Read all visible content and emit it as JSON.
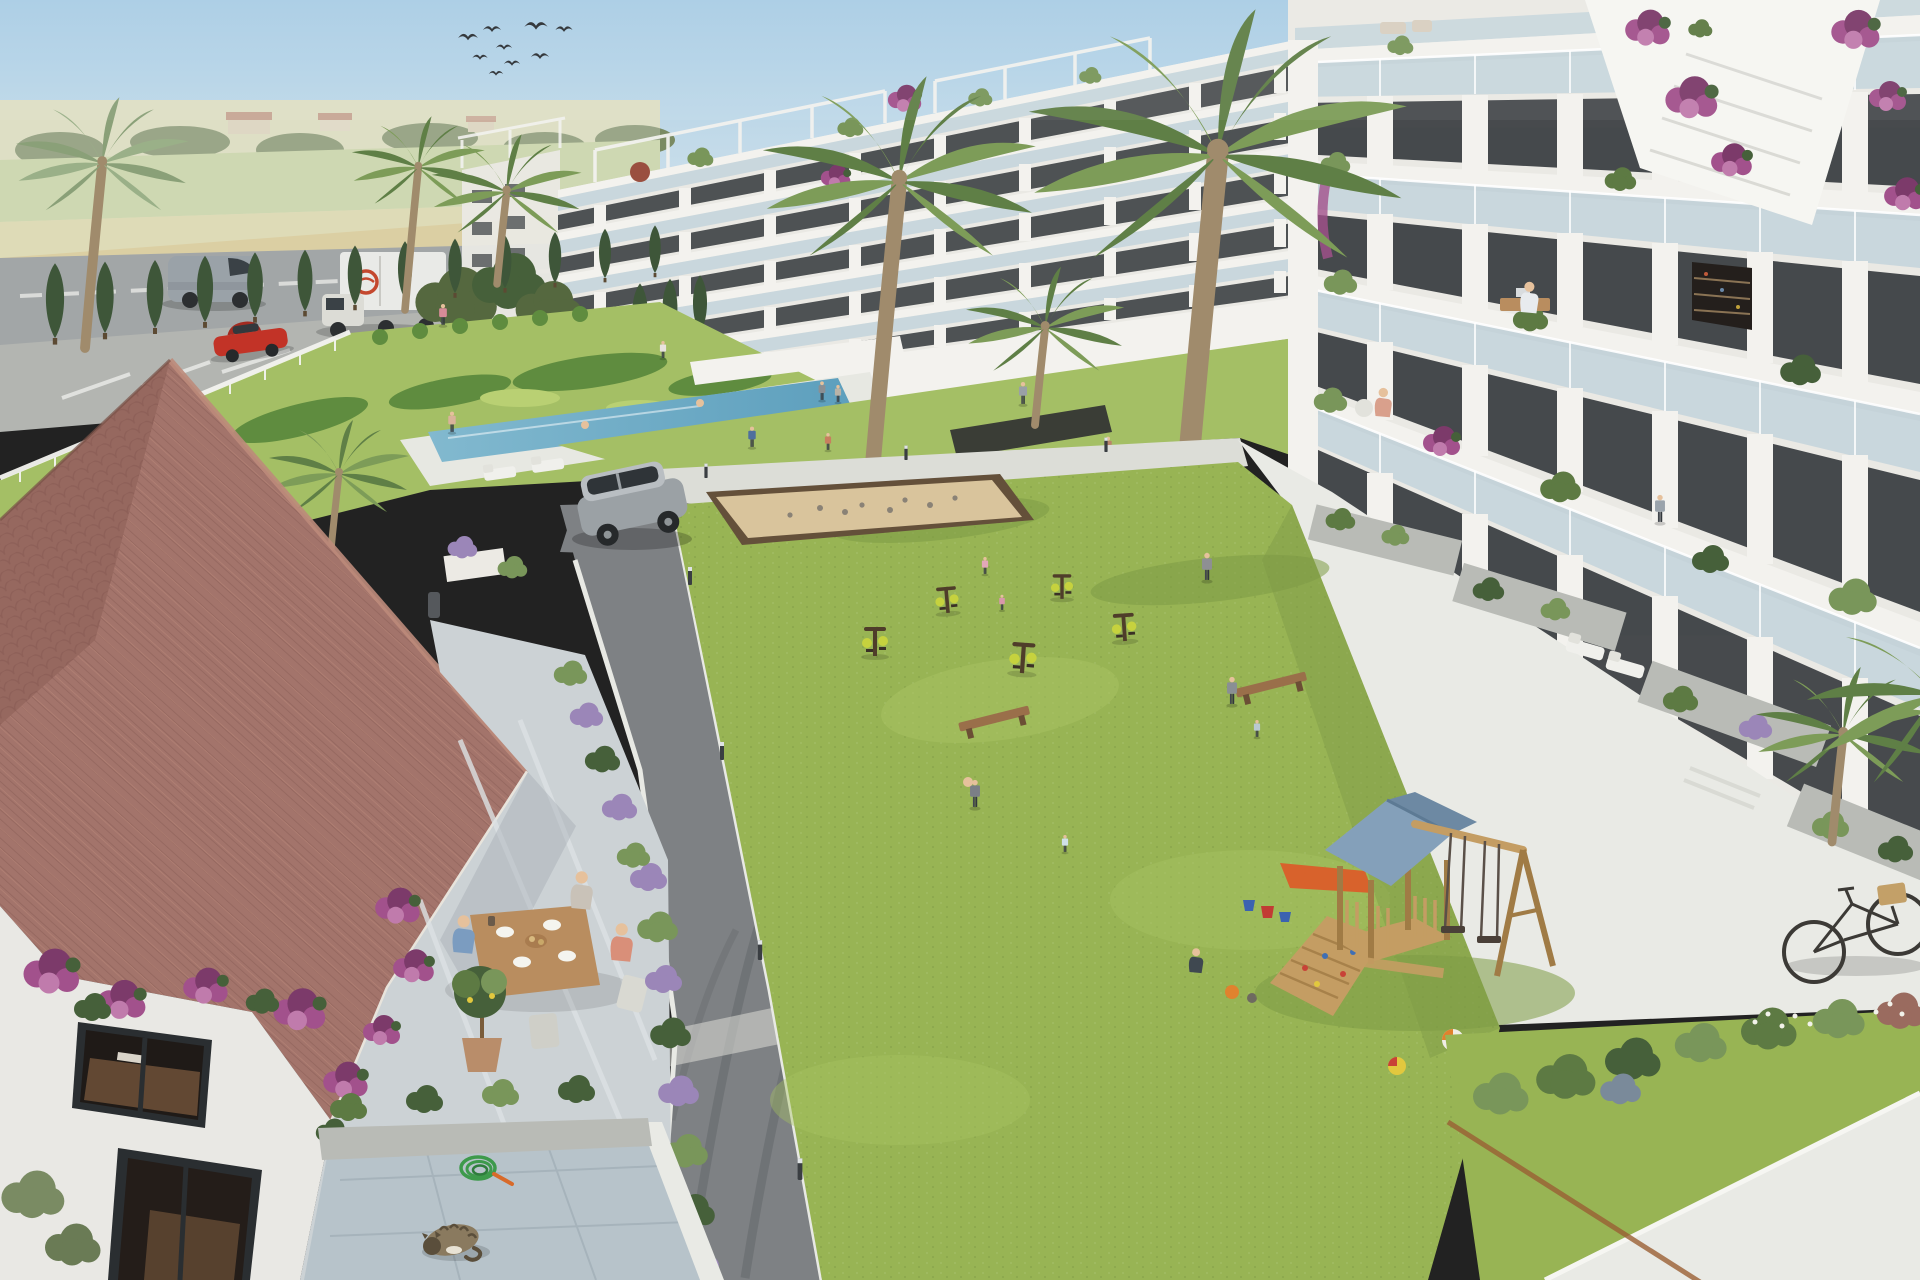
{
  "scene": {
    "title": "Residential complex aerial render",
    "description": "Sunny 3D architectural rendering of a Mediterranean apartment complex: two modern white apartment blocks with glass balconies around a communal lawn with playground, outdoor gym and petanque court, a swimming pool garden, a traditional terracotta-roof house with dining terrace in the foreground, farmland and a road with vehicles in the background, a flock of birds in the sky, a sleeping cat and a bicycle.",
    "objects": {
      "birds": {
        "count": 9
      },
      "vehicles": [
        "delivery-van",
        "box-truck",
        "red-car",
        "silver-suv"
      ],
      "buildings": [
        "far-left-block",
        "background-apartment-block",
        "right-apartment-block",
        "terracotta-roof-house"
      ],
      "amenities": [
        "swimming-pool",
        "decorative-hedge-garden",
        "petanque-court",
        "outdoor-gym",
        "children-playground",
        "communal-lawn",
        "asphalt-path"
      ],
      "playground_parts": [
        "wooden-play-tower",
        "blue-gable-roof",
        "climbing-ramp",
        "double-swing-set",
        "orange-slide",
        "beach-balls",
        "toy-buckets"
      ],
      "terrace_scene": [
        "dining-table",
        "three-diners",
        "potted-citrus-tree",
        "bougainvillea",
        "lavender-pots"
      ],
      "animals": [
        "sleeping-cat"
      ],
      "misc": [
        "garden-hose",
        "bicycle-with-basket",
        "benches",
        "bollard-lights",
        "cypress-row",
        "palm-trees",
        "sunbathers"
      ]
    },
    "people_estimate": 22
  },
  "palette": {
    "sky-top": "#a9cde5",
    "sky-low": "#e3ebee",
    "haze": "#eef0ee",
    "field-far": "#d8d8b6",
    "field-green": "#c3cf9b",
    "field-gold": "#d9d3a2",
    "wheat": "#d5c287",
    "wheat-hi": "#e0d2a0",
    "tree-far": "#7a8a62",
    "tree-dark": "#55683f",
    "road": "#a2a6a7",
    "parking": "#b3b5b1",
    "stripe": "#e8e9e6",
    "cypress": "#3e5639",
    "trunk": "#a08b6c",
    "frond1": "#5f7f46",
    "frond2": "#7d9c58",
    "frond-hazy": "#8aa078",
    "bldg-white": "#f3f2ee",
    "bldg-wall": "#eae9e4",
    "bldg-shadow": "#d7d7d2",
    "slab-shadow": "#b7b8b2",
    "glass": "#c5d5dc",
    "glass-hi": "#dfe9ec",
    "win-dark": "#383c40",
    "win-frame": "#2a2e31",
    "win-warm": "#6e5138",
    "plant1": "#5d7a43",
    "plant2": "#79965a",
    "plant3": "#46603a",
    "boug": "#a2518c",
    "boug-dark": "#7c3a6a",
    "boug-light": "#c07bac",
    "lawn": "#98b454",
    "lawn-hi": "#a7c262",
    "lawn-shade": "#7e9a46",
    "garden-lawn": "#a4bf65",
    "hedge": "#5f8c3f",
    "hedge-hi": "#b9d073",
    "pool1": "#82b9cf",
    "pool2": "#5d9fbd",
    "deck": "#e7e8e2",
    "path-concrete": "#dcddd7",
    "white-stone": "#e9eae5",
    "asphalt": "#7e8184",
    "asphalt-dark": "#6a6d70",
    "curb": "#e8e9e4",
    "sand": "#d9c49c",
    "sand-border": "#64503a",
    "wood": "#b98d5f",
    "bench": "#9a6f4a",
    "play-wood": "#c49d63",
    "play-wood-dark": "#a07b45",
    "play-roof": "#84a0ba",
    "play-roof-dark": "#6d89a3",
    "slide": "#d8622c",
    "eq-brown": "#4f3d2a",
    "eq-yellow": "#c6d23e",
    "roof-tile": "#a3746b",
    "roof-rib": "#8a5d55",
    "roof-hi": "#bd8b7b",
    "roof-plane2": "#96685f",
    "terrace": "#ccd2d5",
    "terrace-hi": "#dde2e4",
    "patio": "#b7c3ca",
    "patio-line": "#a2b0b8",
    "house-wall": "#e9e8e4",
    "skin": "#e6c19c",
    "pants": "#41464c",
    "suv": "#9ba1a5",
    "van": "#9aa2a8",
    "truck": "#e9eae7",
    "red-car": "#c23327",
    "logo-red": "#c4482e",
    "cat": "#8a7a5f",
    "cat-dark": "#5a4e3b",
    "hose": "#3d9a4b",
    "nozzle": "#d86a2a",
    "bike": "#3c3a36",
    "basket": "#c3a068",
    "ball-orange": "#e0822e",
    "ball-blue": "#3f6fb5",
    "ball-yellow": "#e2c83e",
    "ball-red": "#c84237",
    "bucket-red": "#c23b34",
    "bucket-blue": "#3b62b0",
    "lavender": "#9b86b8",
    "white-flower": "#f2f2ea",
    "corten": "#9a5f33",
    "concrete-planter": "#b9bbb6",
    "soil": "#4a4238"
  }
}
